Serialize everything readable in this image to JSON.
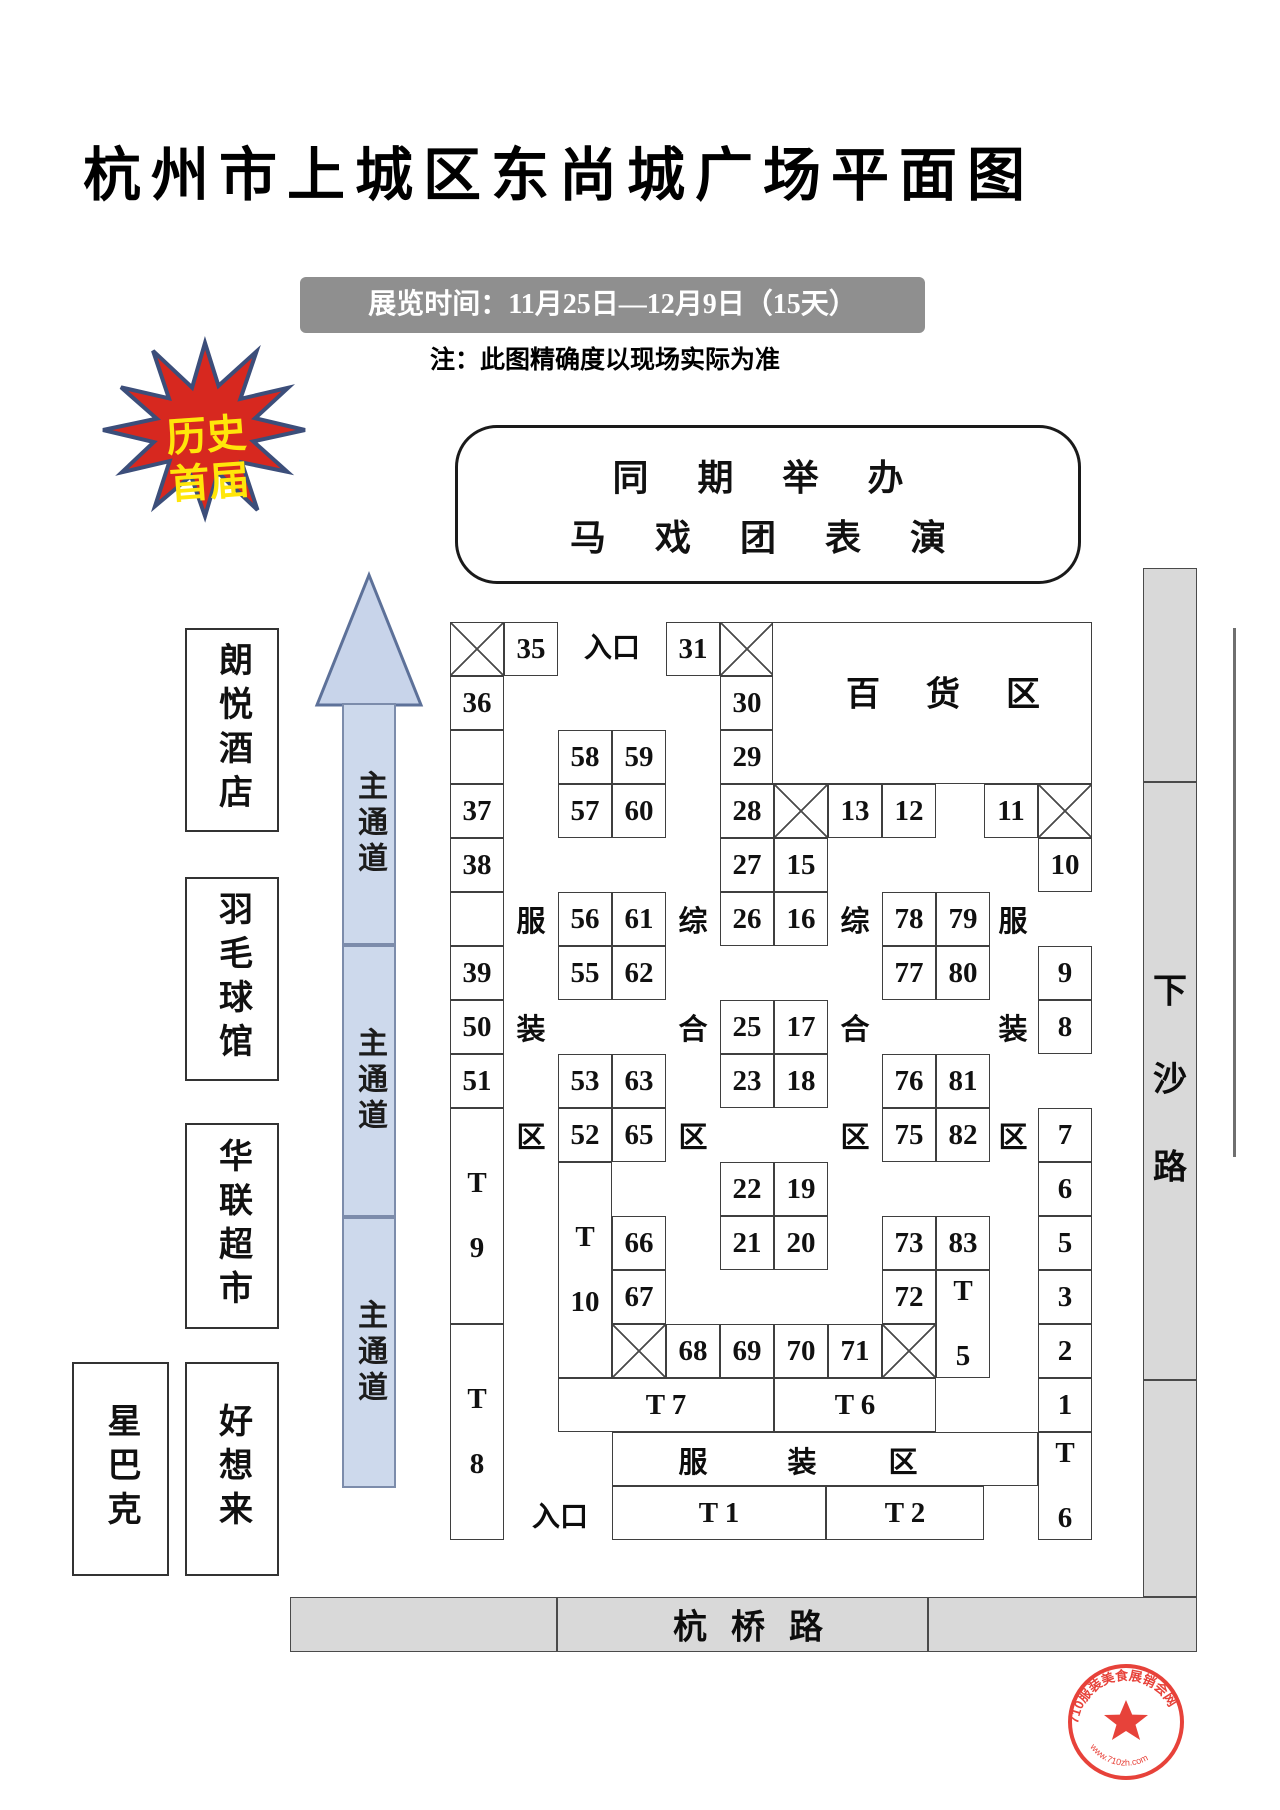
{
  "page": {
    "title": "杭州市上城区东尚城广场平面图",
    "banner": "展览时间：11月25日—12月9日（15天）",
    "note": "注：此图精确度以现场实际为准"
  },
  "event_box": {
    "line1": "同 期 举 办",
    "line2": "马 戏 团 表 演"
  },
  "starburst": {
    "line1": "历史",
    "line2": "首届",
    "fill": "#d7281f",
    "stroke": "#3c4e7a",
    "text_color": "#ffe60a"
  },
  "buildings": [
    {
      "name": "朗悦酒店",
      "x": 185,
      "y": 628,
      "w": 90,
      "h": 200
    },
    {
      "name": "羽毛球馆",
      "x": 185,
      "y": 877,
      "w": 90,
      "h": 200
    },
    {
      "name": "华联超市",
      "x": 185,
      "y": 1123,
      "w": 90,
      "h": 202
    },
    {
      "name": "星巴克",
      "x": 72,
      "y": 1362,
      "w": 93,
      "h": 210
    },
    {
      "name": "好想来",
      "x": 185,
      "y": 1362,
      "w": 90,
      "h": 210
    }
  ],
  "aisle": {
    "label": "主通道",
    "x": 342,
    "w": 54,
    "segments": [
      {
        "y": 703,
        "h": 242
      },
      {
        "y": 945,
        "h": 272
      },
      {
        "y": 1217,
        "h": 271
      }
    ],
    "arrow_points": "369,575 317,705 421,705"
  },
  "roads": {
    "xiasha": {
      "name": "下沙路",
      "x": 1143,
      "w": 54,
      "segments": [
        {
          "y": 568,
          "h": 214
        },
        {
          "y": 782,
          "h": 598
        },
        {
          "y": 1380,
          "h": 217
        }
      ]
    },
    "hangqiao": {
      "name": "杭桥路",
      "y": 1597,
      "h": 55,
      "segments": [
        {
          "x": 290,
          "w": 267
        },
        {
          "x": 557,
          "w": 371
        },
        {
          "x": 928,
          "w": 269
        }
      ]
    }
  },
  "booths": [
    {
      "k": "x",
      "x": 450,
      "y": 622
    },
    {
      "l": "35",
      "x": 504,
      "y": 622
    },
    {
      "l": "36",
      "x": 450,
      "y": 676
    },
    {
      "k": "e",
      "x": 450,
      "y": 730
    },
    {
      "l": "37",
      "x": 450,
      "y": 784
    },
    {
      "l": "38",
      "x": 450,
      "y": 838
    },
    {
      "k": "e",
      "x": 450,
      "y": 892
    },
    {
      "l": "39",
      "x": 450,
      "y": 946
    },
    {
      "l": "50",
      "x": 450,
      "y": 1000
    },
    {
      "l": "51",
      "x": 450,
      "y": 1054
    },
    {
      "lines": [
        "T",
        "9"
      ],
      "x": 450,
      "y": 1108,
      "h": 216
    },
    {
      "lines": [
        "T",
        "8"
      ],
      "x": 450,
      "y": 1324,
      "h": 216
    },
    {
      "l": "58",
      "x": 558,
      "y": 730
    },
    {
      "l": "59",
      "x": 612,
      "y": 730
    },
    {
      "l": "57",
      "x": 558,
      "y": 784
    },
    {
      "l": "60",
      "x": 612,
      "y": 784
    },
    {
      "l": "56",
      "x": 558,
      "y": 892
    },
    {
      "l": "61",
      "x": 612,
      "y": 892
    },
    {
      "l": "55",
      "x": 558,
      "y": 946
    },
    {
      "l": "62",
      "x": 612,
      "y": 946
    },
    {
      "l": "53",
      "x": 558,
      "y": 1054
    },
    {
      "l": "63",
      "x": 612,
      "y": 1054
    },
    {
      "l": "52",
      "x": 558,
      "y": 1108
    },
    {
      "l": "65",
      "x": 612,
      "y": 1108
    },
    {
      "lines": [
        "T",
        "10"
      ],
      "x": 558,
      "y": 1162,
      "h": 216
    },
    {
      "l": "66",
      "x": 612,
      "y": 1216
    },
    {
      "l": "67",
      "x": 612,
      "y": 1270
    },
    {
      "k": "x",
      "x": 612,
      "y": 1324
    },
    {
      "l": "68",
      "x": 666,
      "y": 1324
    },
    {
      "l": "69",
      "x": 720,
      "y": 1324
    },
    {
      "l": "70",
      "x": 774,
      "y": 1324
    },
    {
      "l": "71",
      "x": 828,
      "y": 1324
    },
    {
      "k": "x",
      "x": 882,
      "y": 1324
    },
    {
      "l": "31",
      "x": 666,
      "y": 622
    },
    {
      "k": "x",
      "x": 720,
      "y": 622
    },
    {
      "l": "30",
      "x": 720,
      "y": 676
    },
    {
      "l": "29",
      "x": 720,
      "y": 730
    },
    {
      "l": "28",
      "x": 720,
      "y": 784
    },
    {
      "k": "x",
      "x": 774,
      "y": 784
    },
    {
      "l": "13",
      "x": 828,
      "y": 784
    },
    {
      "l": "12",
      "x": 882,
      "y": 784
    },
    {
      "l": "27",
      "x": 720,
      "y": 838
    },
    {
      "l": "15",
      "x": 774,
      "y": 838
    },
    {
      "l": "26",
      "x": 720,
      "y": 892
    },
    {
      "l": "16",
      "x": 774,
      "y": 892
    },
    {
      "l": "25",
      "x": 720,
      "y": 1000
    },
    {
      "l": "17",
      "x": 774,
      "y": 1000
    },
    {
      "l": "23",
      "x": 720,
      "y": 1054
    },
    {
      "l": "18",
      "x": 774,
      "y": 1054
    },
    {
      "l": "22",
      "x": 720,
      "y": 1162
    },
    {
      "l": "19",
      "x": 774,
      "y": 1162
    },
    {
      "l": "21",
      "x": 720,
      "y": 1216
    },
    {
      "l": "20",
      "x": 774,
      "y": 1216
    },
    {
      "l": "78",
      "x": 882,
      "y": 892
    },
    {
      "l": "79",
      "x": 936,
      "y": 892
    },
    {
      "l": "77",
      "x": 882,
      "y": 946
    },
    {
      "l": "80",
      "x": 936,
      "y": 946
    },
    {
      "l": "76",
      "x": 882,
      "y": 1054
    },
    {
      "l": "81",
      "x": 936,
      "y": 1054
    },
    {
      "l": "75",
      "x": 882,
      "y": 1108
    },
    {
      "l": "82",
      "x": 936,
      "y": 1108
    },
    {
      "l": "73",
      "x": 882,
      "y": 1216
    },
    {
      "l": "83",
      "x": 936,
      "y": 1216
    },
    {
      "l": "72",
      "x": 882,
      "y": 1270
    },
    {
      "lines": [
        "T",
        "5"
      ],
      "x": 936,
      "y": 1270,
      "h": 108
    },
    {
      "l": "",
      "x": 772,
      "y": 622,
      "w": 320,
      "h": 162,
      "name": "department-store-area-box"
    },
    {
      "l": "11",
      "x": 984,
      "y": 784
    },
    {
      "k": "x",
      "x": 1038,
      "y": 784
    },
    {
      "l": "10",
      "x": 1038,
      "y": 838
    },
    {
      "l": "9",
      "x": 1038,
      "y": 946
    },
    {
      "l": "8",
      "x": 1038,
      "y": 1000
    },
    {
      "l": "7",
      "x": 1038,
      "y": 1108
    },
    {
      "l": "6",
      "x": 1038,
      "y": 1162
    },
    {
      "l": "5",
      "x": 1038,
      "y": 1216
    },
    {
      "l": "3",
      "x": 1038,
      "y": 1270
    },
    {
      "l": "2",
      "x": 1038,
      "y": 1324
    },
    {
      "l": "1",
      "x": 1038,
      "y": 1378
    },
    {
      "lines": [
        "T",
        "6"
      ],
      "x": 1038,
      "y": 1432,
      "h": 108
    },
    {
      "l": "T 7",
      "x": 558,
      "y": 1378,
      "w": 216
    },
    {
      "l": "T 6",
      "x": 774,
      "y": 1378,
      "w": 162
    },
    {
      "l": "",
      "x": 612,
      "y": 1432,
      "w": 426,
      "name": "clothing-zone-band"
    },
    {
      "l": "T 1",
      "x": 612,
      "y": 1486,
      "w": 214
    },
    {
      "l": "T 2",
      "x": 826,
      "y": 1486,
      "w": 158
    }
  ],
  "map_chars": [
    {
      "c": "百",
      "x": 863,
      "y": 691,
      "s": 34
    },
    {
      "c": "货",
      "x": 943,
      "y": 691,
      "s": 34
    },
    {
      "c": "区",
      "x": 1023,
      "y": 691,
      "s": 34
    },
    {
      "c": "服",
      "x": 531,
      "y": 919,
      "s": 29
    },
    {
      "c": "装",
      "x": 531,
      "y": 1027,
      "s": 29
    },
    {
      "c": "区",
      "x": 531,
      "y": 1135,
      "s": 29
    },
    {
      "c": "综",
      "x": 693,
      "y": 919,
      "s": 29
    },
    {
      "c": "合",
      "x": 693,
      "y": 1027,
      "s": 29
    },
    {
      "c": "区",
      "x": 693,
      "y": 1135,
      "s": 29
    },
    {
      "c": "综",
      "x": 855,
      "y": 919,
      "s": 29
    },
    {
      "c": "合",
      "x": 855,
      "y": 1027,
      "s": 29
    },
    {
      "c": "区",
      "x": 855,
      "y": 1135,
      "s": 29
    },
    {
      "c": "服",
      "x": 1013,
      "y": 919,
      "s": 29
    },
    {
      "c": "装",
      "x": 1013,
      "y": 1027,
      "s": 29
    },
    {
      "c": "区",
      "x": 1013,
      "y": 1135,
      "s": 29
    },
    {
      "c": "服",
      "x": 693,
      "y": 1460,
      "s": 29
    },
    {
      "c": "装",
      "x": 802,
      "y": 1460,
      "s": 29
    },
    {
      "c": "区",
      "x": 903,
      "y": 1460,
      "s": 29
    },
    {
      "c": "入口",
      "x": 612,
      "y": 646,
      "s": 28
    },
    {
      "c": "入口",
      "x": 560,
      "y": 1515,
      "s": 28
    },
    {
      "c": "杭",
      "x": 690,
      "y": 1624,
      "s": 34
    },
    {
      "c": "桥",
      "x": 748,
      "y": 1624,
      "s": 34
    },
    {
      "c": "路",
      "x": 806,
      "y": 1624,
      "s": 34
    },
    {
      "c": "下",
      "x": 1170,
      "y": 988,
      "s": 34
    },
    {
      "c": "沙",
      "x": 1170,
      "y": 1076,
      "s": 34
    },
    {
      "c": "路",
      "x": 1170,
      "y": 1164,
      "s": 34
    }
  ],
  "stamp": {
    "top_text": "710服装美食展销会网",
    "bottom_text": "www.710zh.com",
    "color": "#e6332a"
  }
}
